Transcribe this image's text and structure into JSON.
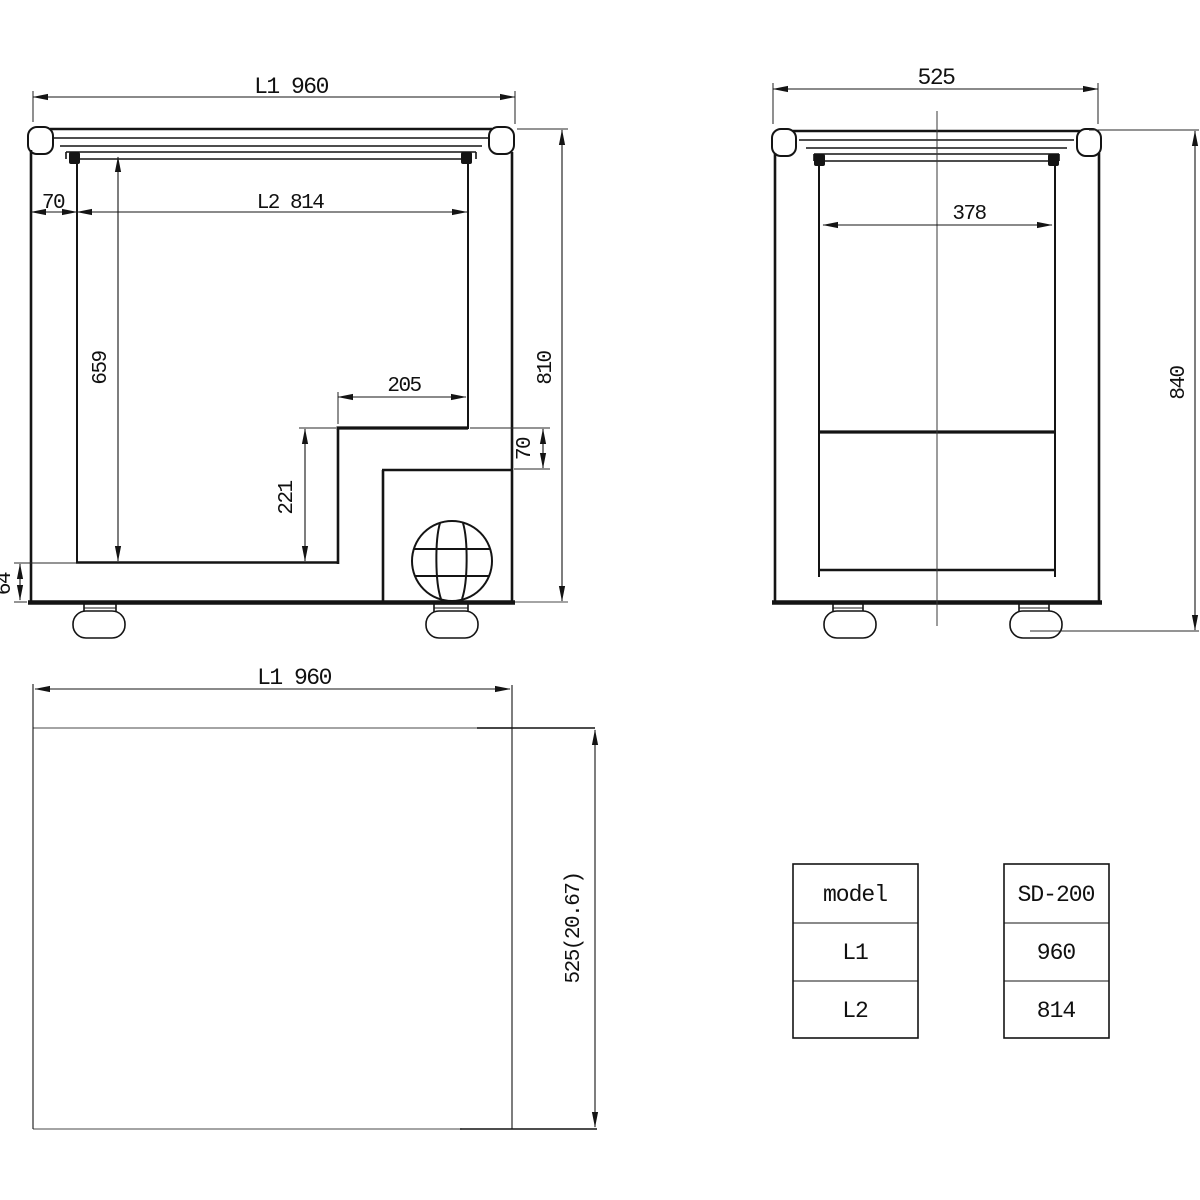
{
  "drawing": {
    "front_view": {
      "dims": {
        "overall_width": "L1 960",
        "left_wall_inset": "70",
        "inner_width": "L2 814",
        "inner_depth": "659",
        "step_width": "205",
        "step_height": "221",
        "base_thickness": "64",
        "body_height": "810",
        "step_clearance": "70"
      }
    },
    "side_view": {
      "dims": {
        "overall_depth": "525",
        "inner_depth": "378",
        "overall_height": "840"
      }
    },
    "top_view": {
      "dims": {
        "overall_width": "L1 960",
        "overall_depth": "525(20.67)"
      }
    }
  },
  "spec_table": {
    "labels": [
      "model",
      "L1",
      "L2"
    ],
    "values": [
      "SD-200",
      "960",
      "814"
    ]
  }
}
